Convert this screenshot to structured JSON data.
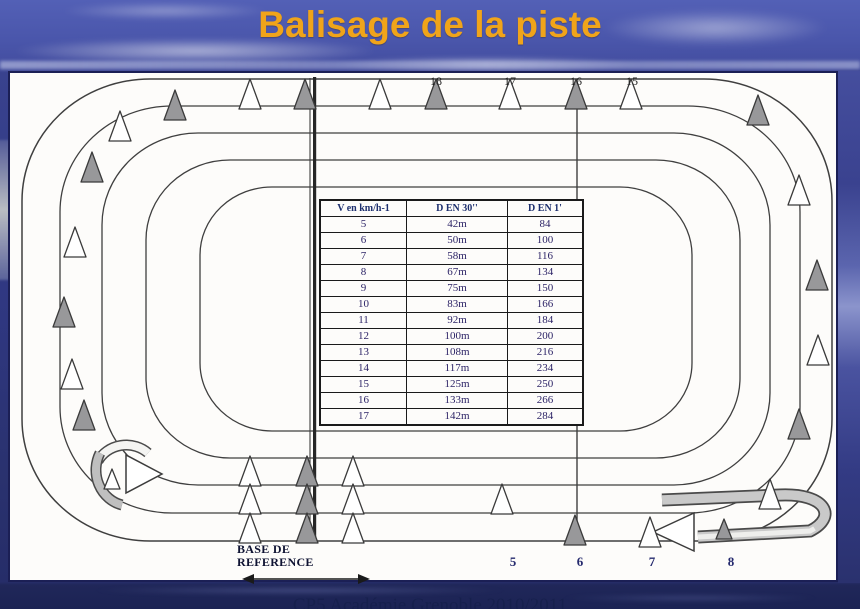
{
  "slide": {
    "title": "Balisage de la piste",
    "footer": "CP5 Académie Grenoble 2010/2011"
  },
  "table": {
    "headers": [
      "V en km/h-1",
      "D EN 30''",
      "D EN 1'"
    ],
    "rows": [
      [
        "5",
        "42m",
        "84"
      ],
      [
        "6",
        "50m",
        "100"
      ],
      [
        "7",
        "58m",
        "116"
      ],
      [
        "8",
        "67m",
        "134"
      ],
      [
        "9",
        "75m",
        "150"
      ],
      [
        "10",
        "83m",
        "166"
      ],
      [
        "11",
        "92m",
        "184"
      ],
      [
        "12",
        "100m",
        "200"
      ],
      [
        "13",
        "108m",
        "216"
      ],
      [
        "14",
        "117m",
        "234"
      ],
      [
        "15",
        "125m",
        "250"
      ],
      [
        "16",
        "133m",
        "266"
      ],
      [
        "17",
        "142m",
        "284"
      ]
    ]
  },
  "base_reference": {
    "line1": "BASE DE",
    "line2": "REFERENCE"
  },
  "markers": {
    "top": [
      {
        "label": "18",
        "x": 426
      },
      {
        "label": "17",
        "x": 500
      },
      {
        "label": "16",
        "x": 566
      },
      {
        "label": "15",
        "x": 622
      }
    ],
    "bottom": [
      {
        "label": "5",
        "x": 503
      },
      {
        "label": "6",
        "x": 570
      },
      {
        "label": "7",
        "x": 642
      },
      {
        "label": "8",
        "x": 721
      }
    ]
  },
  "cones": [
    {
      "x": 240,
      "y": 36,
      "c": "w"
    },
    {
      "x": 295,
      "y": 36,
      "c": "g"
    },
    {
      "x": 370,
      "y": 36,
      "c": "w"
    },
    {
      "x": 426,
      "y": 36,
      "c": "g"
    },
    {
      "x": 500,
      "y": 36,
      "c": "w"
    },
    {
      "x": 566,
      "y": 36,
      "c": "g"
    },
    {
      "x": 621,
      "y": 36,
      "c": "w"
    },
    {
      "x": 165,
      "y": 47,
      "c": "g"
    },
    {
      "x": 110,
      "y": 68,
      "c": "w"
    },
    {
      "x": 82,
      "y": 109,
      "c": "g"
    },
    {
      "x": 65,
      "y": 184,
      "c": "w"
    },
    {
      "x": 54,
      "y": 254,
      "c": "g"
    },
    {
      "x": 62,
      "y": 316,
      "c": "w"
    },
    {
      "x": 74,
      "y": 357,
      "c": "g"
    },
    {
      "x": 102,
      "y": 416,
      "c": "w",
      "s": 1
    },
    {
      "x": 240,
      "y": 413,
      "c": "w"
    },
    {
      "x": 240,
      "y": 441,
      "c": "w"
    },
    {
      "x": 240,
      "y": 470,
      "c": "w"
    },
    {
      "x": 297,
      "y": 413,
      "c": "g"
    },
    {
      "x": 297,
      "y": 441,
      "c": "g"
    },
    {
      "x": 297,
      "y": 470,
      "c": "g"
    },
    {
      "x": 343,
      "y": 413,
      "c": "w"
    },
    {
      "x": 343,
      "y": 441,
      "c": "w"
    },
    {
      "x": 343,
      "y": 470,
      "c": "w"
    },
    {
      "x": 492,
      "y": 441,
      "c": "w"
    },
    {
      "x": 565,
      "y": 472,
      "c": "g"
    },
    {
      "x": 640,
      "y": 474,
      "c": "w"
    },
    {
      "x": 714,
      "y": 466,
      "c": "g",
      "s": 1
    },
    {
      "x": 760,
      "y": 436,
      "c": "w"
    },
    {
      "x": 789,
      "y": 366,
      "c": "g"
    },
    {
      "x": 808,
      "y": 292,
      "c": "w"
    },
    {
      "x": 807,
      "y": 217,
      "c": "g"
    },
    {
      "x": 789,
      "y": 132,
      "c": "w"
    },
    {
      "x": 748,
      "y": 52,
      "c": "g"
    }
  ],
  "colors": {
    "title_orange": "#F0A41A",
    "sky_blue": "#4A56AB",
    "diagram_bg": "#FDFCFA",
    "cone_gray": "#98989A",
    "cone_white": "#FFFFFF",
    "track_line": "#3F3F3F",
    "navy_text": "#252A6E"
  }
}
